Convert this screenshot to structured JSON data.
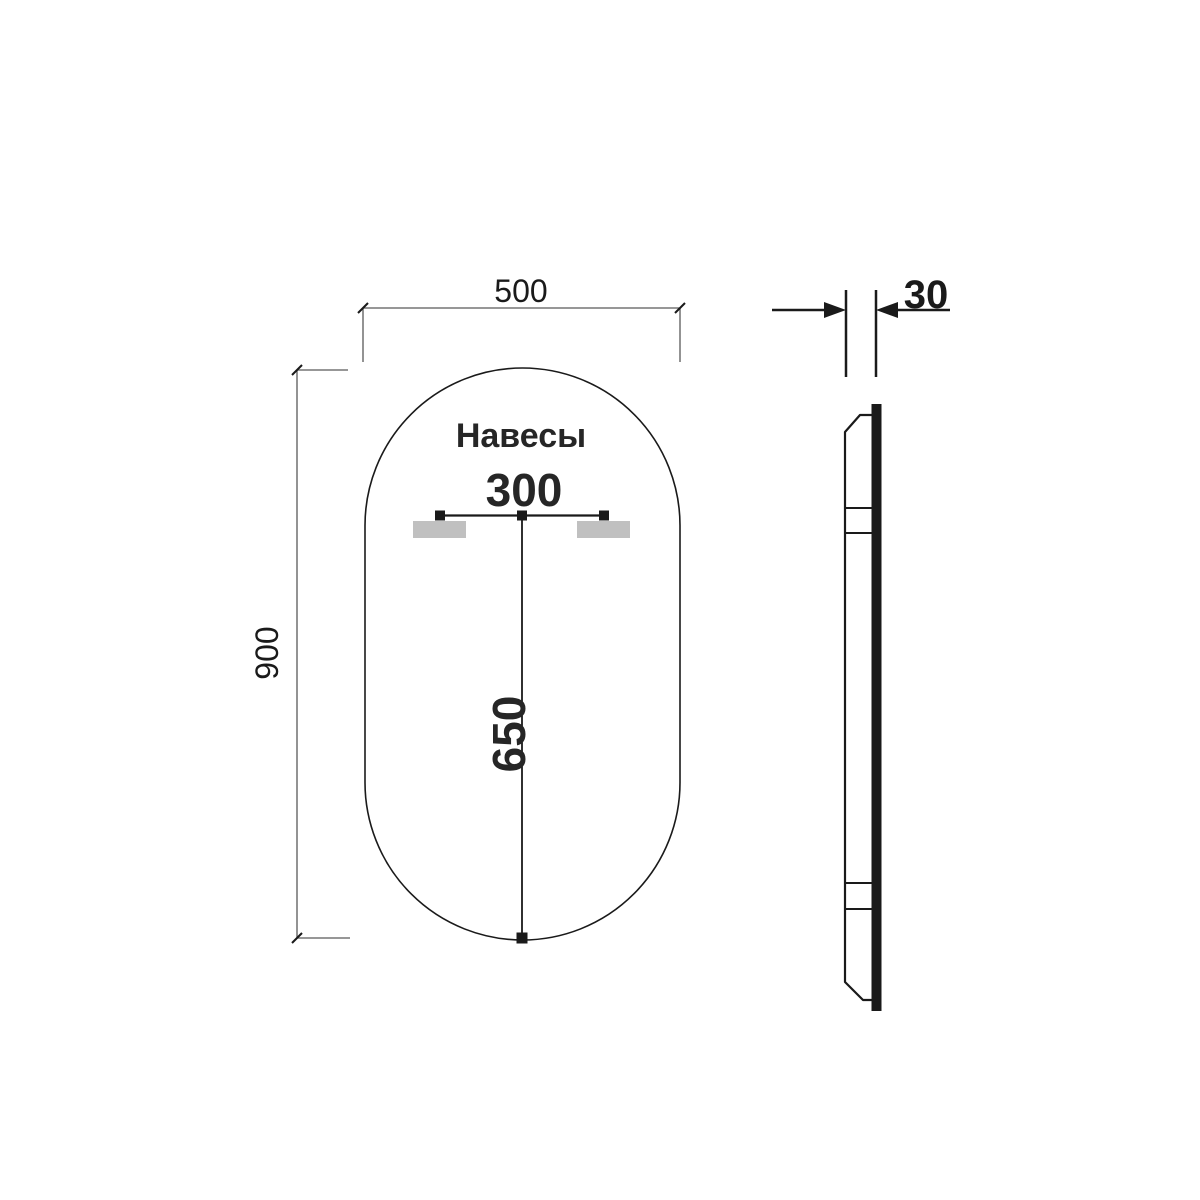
{
  "page": {
    "background": "#ffffff"
  },
  "drawing": {
    "annotation": "Навесы",
    "dimensions": {
      "width": "500",
      "height": "900",
      "hanger_spacing": "300",
      "hanger_center_height": "650",
      "thickness": "30"
    },
    "colors": {
      "object_line": "#1a1a1a",
      "dimension_line": "#595959",
      "bracket_fill": "#c0c0c0"
    }
  }
}
